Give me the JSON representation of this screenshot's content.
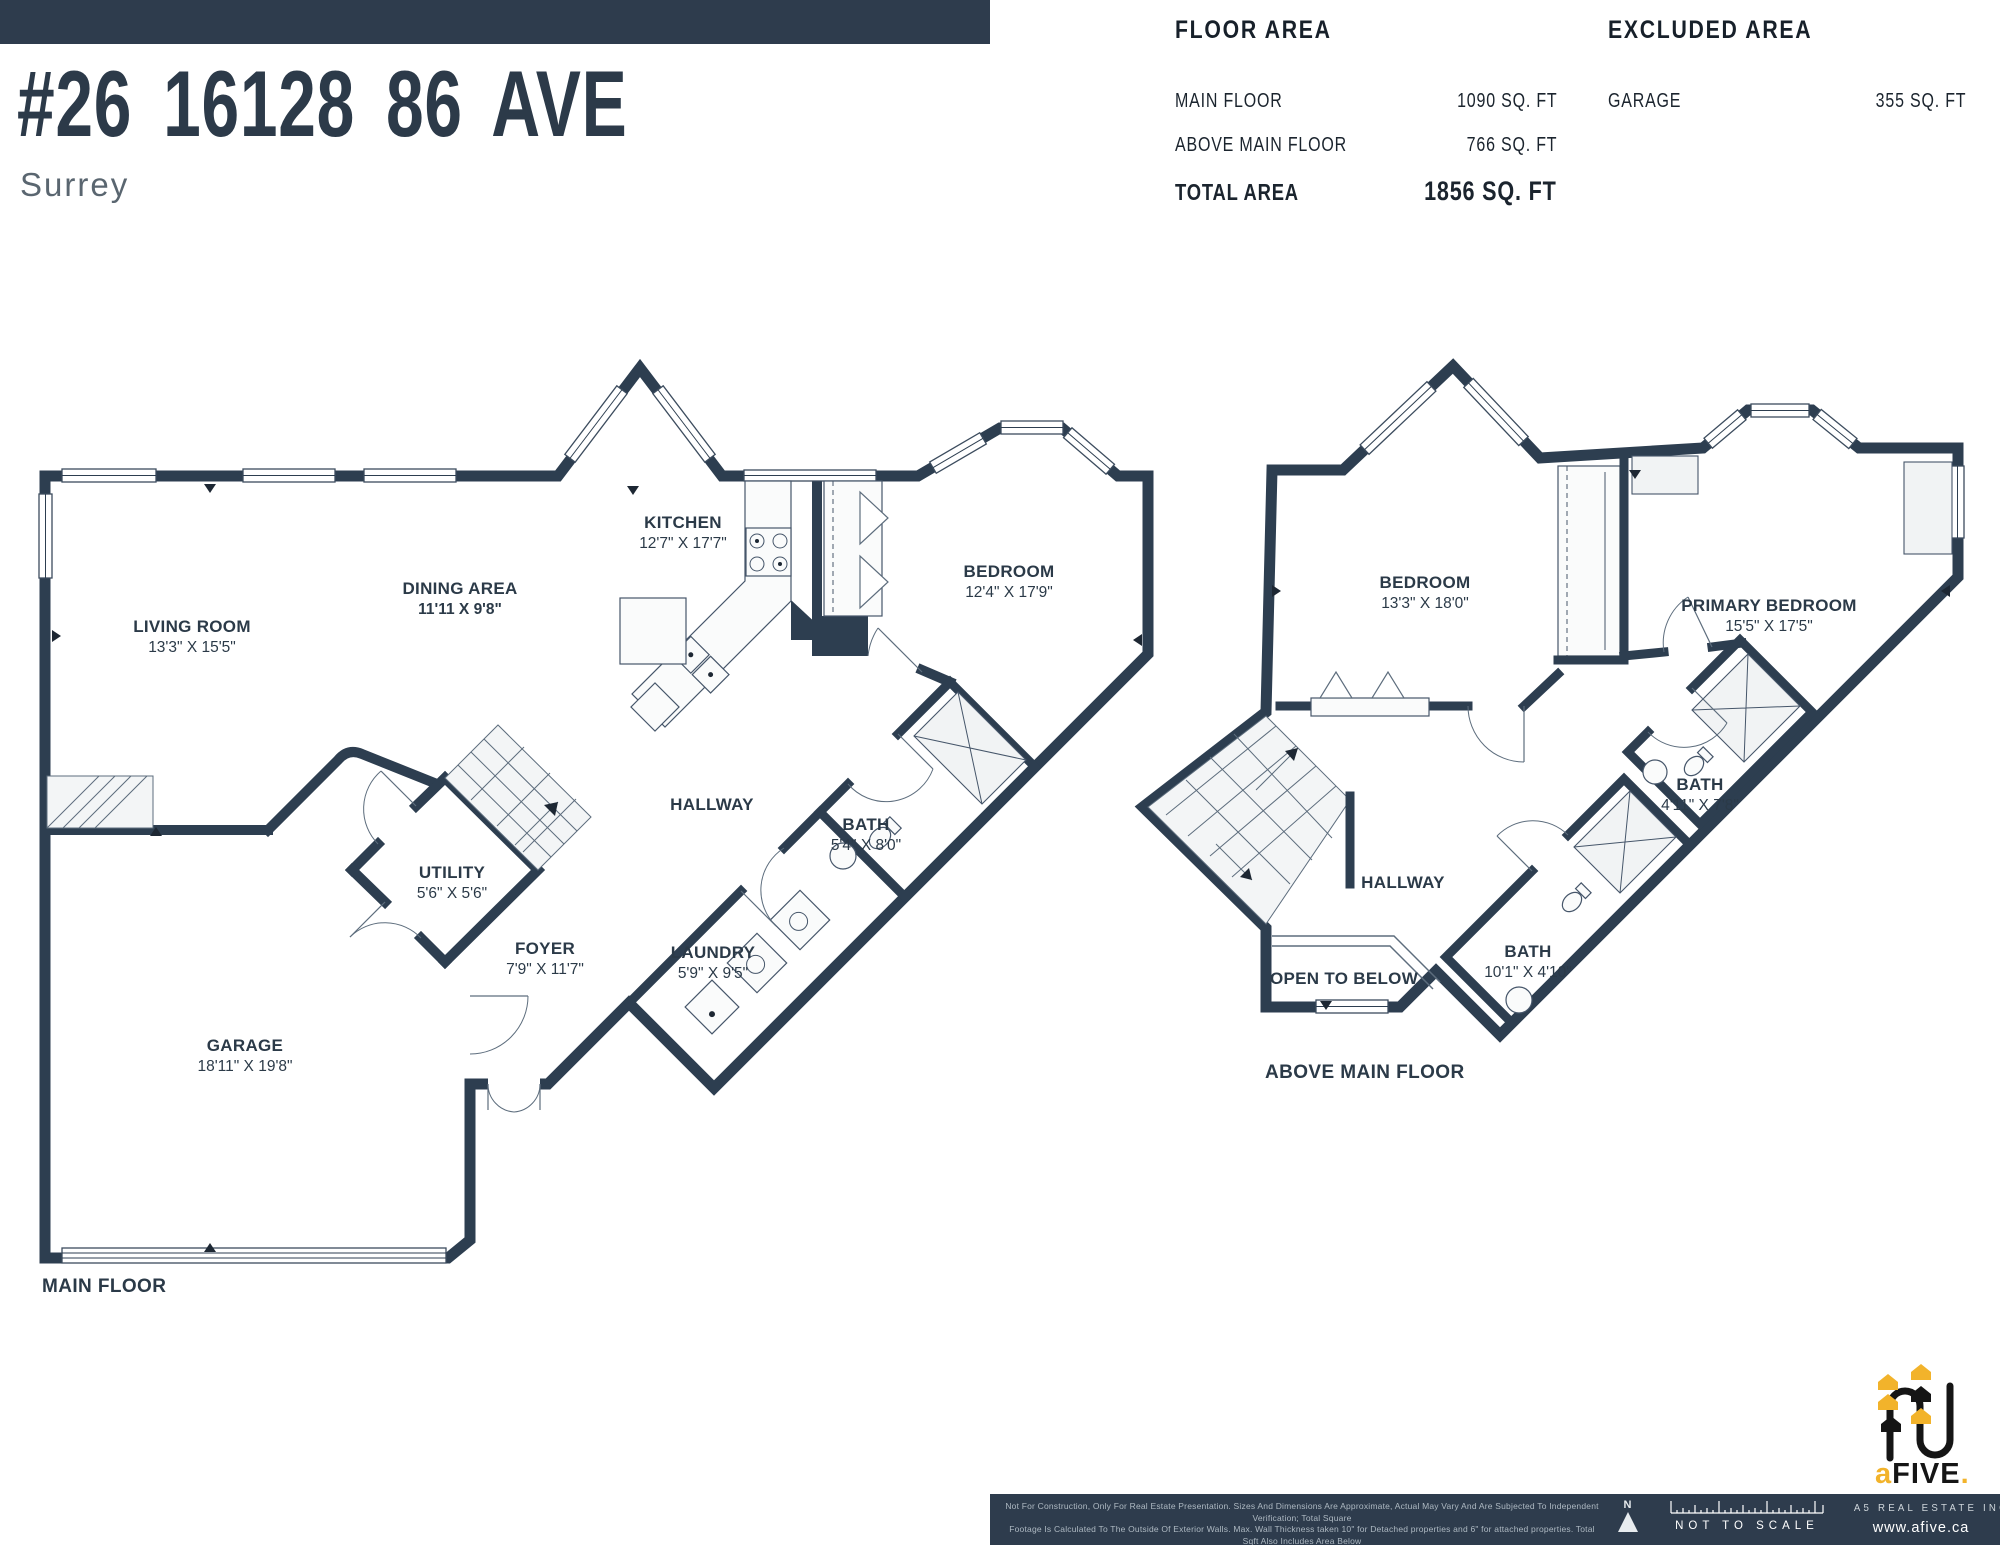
{
  "header": {
    "title": "#26 16128 86 AVE",
    "city": "Surrey"
  },
  "floor_area": {
    "title": "FLOOR AREA",
    "rows": [
      {
        "label": "MAIN FLOOR",
        "value": "1090 SQ. FT"
      },
      {
        "label": "ABOVE MAIN FLOOR",
        "value": "766 SQ. FT"
      }
    ],
    "total_label": "TOTAL AREA",
    "total_value": "1856 SQ. FT"
  },
  "excluded_area": {
    "title": "EXCLUDED AREA",
    "rows": [
      {
        "label": "GARAGE",
        "value": "355 SQ. FT"
      }
    ]
  },
  "main_floor": {
    "caption": "MAIN FLOOR",
    "rooms": {
      "living": {
        "name": "LIVING ROOM",
        "dims": "13'3\" X 15'5\""
      },
      "dining": {
        "name": "DINING AREA",
        "dims": "11'11 X 9'8\""
      },
      "kitchen": {
        "name": "KITCHEN",
        "dims": "12'7\" X 17'7\""
      },
      "bedroom": {
        "name": "BEDROOM",
        "dims": "12'4\" X 17'9\""
      },
      "hallway": {
        "name": "HALLWAY"
      },
      "bath": {
        "name": "BATH",
        "dims": "5'4\" X 8'0\""
      },
      "utility": {
        "name": "UTILITY",
        "dims": "5'6\" X 5'6\""
      },
      "foyer": {
        "name": "FOYER",
        "dims": "7'9\" X 11'7\""
      },
      "laundry": {
        "name": "LAUNDRY",
        "dims": "5'9\" X 9'5\""
      },
      "garage": {
        "name": "GARAGE",
        "dims": "18'11\" X 19'8\""
      }
    }
  },
  "above_floor": {
    "caption": "ABOVE MAIN FLOOR",
    "rooms": {
      "bedroom": {
        "name": "BEDROOM",
        "dims": "13'3\" X 18'0\""
      },
      "primary": {
        "name": "PRIMARY BEDROOM",
        "dims": "15'5\" X 17'5\""
      },
      "bath1": {
        "name": "BATH",
        "dims": "4'11\" X 7'8\""
      },
      "bath2": {
        "name": "BATH",
        "dims": "10'1\" X 4'10\""
      },
      "hallway": {
        "name": "HALLWAY"
      },
      "open_below": {
        "name": "OPEN TO BELOW"
      }
    }
  },
  "footer": {
    "disclaimer_line1": "Not For Construction, Only For Real Estate Presentation. Sizes And Dimensions Are Approximate, Actual May Vary And Are Subjected To Independent Verification; Total Square",
    "disclaimer_line2": "Footage Is Calculated To The Outside Of Exterior Walls.  Max. Wall Thickness taken 10\" for Detached properties and 6\" for attached properties. Total Sqft Also Includes Area Below",
    "disclaimer_line3": "Grade. Adding Up Room Sizes Will Not Match The Total Square Footage. All Floor Plan Is Not To Scale. E&O Insured.  Valid For One Year From Date Floor Plan Created. oct 2024",
    "compass_label": "N",
    "not_to_scale": "NOT TO SCALE",
    "company": "A5 REAL ESTATE INC.",
    "website": "www.afive.ca",
    "logo": {
      "prefix": "a",
      "main": "FIVE",
      "suffix": "."
    }
  },
  "colors": {
    "wall": "#2d3e50",
    "bar": "#2e3c4d",
    "accent": "#f2b32b",
    "text": "#2b3a48"
  }
}
